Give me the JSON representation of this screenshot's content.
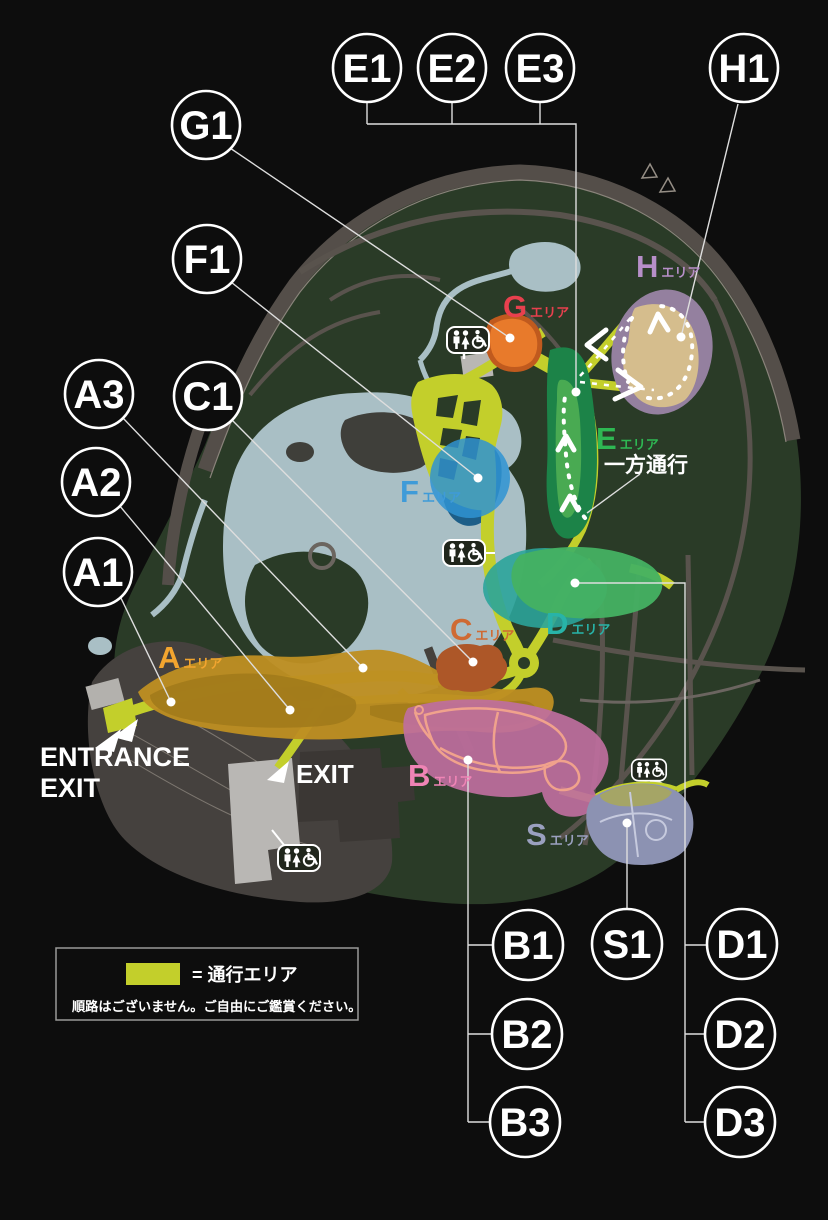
{
  "colors": {
    "background": "#0d0d0d",
    "park_green": "#2a3b27",
    "perimeter_gray": "#544e49",
    "road_gray": "#59534d",
    "entrance_zone_gray": "#45413e",
    "building_light": "#b9b7b4",
    "building_dark": "#3b3734",
    "pond_blue": "#a9bfc5",
    "deep_blue": "#1d5e88",
    "path_yellow": "#c3cf2b",
    "area_a": "#bd8f22",
    "area_a_dark": "#a0791a",
    "area_b": "#bf6f9e",
    "area_b_outline": "#f0a28c",
    "area_c": "#ad5728",
    "area_d_teal": "#2ba49a",
    "area_d_green": "#45b162",
    "area_e": "#1c8348",
    "area_e_light": "#4fae53",
    "area_f": "#2f93d2",
    "area_g": "#e87a2b",
    "area_g_border": "#c05a1e",
    "area_h_outer": "#94809f",
    "area_h_inner": "#d5bd8d",
    "area_s": "#8c92b2",
    "area_s_olive": "#a5a566",
    "label_a": "#f2a52f",
    "label_b": "#ef84b5",
    "label_c": "#cf6a33",
    "label_d": "#28b3a8",
    "label_e": "#2eb853",
    "label_f": "#3f9bd8",
    "label_g": "#e8404e",
    "label_h": "#b78fc9",
    "label_s": "#9aa0bf"
  },
  "markers": {
    "e1": "E1",
    "e2": "E2",
    "e3": "E3",
    "h1": "H1",
    "g1": "G1",
    "f1": "F1",
    "a3": "A3",
    "c1": "C1",
    "a2": "A2",
    "a1": "A1",
    "b1": "B1",
    "s1": "S1",
    "d1": "D1",
    "b2": "B2",
    "d2": "D2",
    "b3": "B3",
    "d3": "D3"
  },
  "areas": {
    "a": {
      "letter": "A",
      "suffix": "エリア"
    },
    "b": {
      "letter": "B",
      "suffix": "エリア"
    },
    "c": {
      "letter": "C",
      "suffix": "エリア"
    },
    "d": {
      "letter": "D",
      "suffix": "エリア"
    },
    "e": {
      "letter": "E",
      "suffix": "エリア"
    },
    "f": {
      "letter": "F",
      "suffix": "エリア"
    },
    "g": {
      "letter": "G",
      "suffix": "エリア"
    },
    "h": {
      "letter": "H",
      "suffix": "エリア"
    },
    "s": {
      "letter": "S",
      "suffix": "エリア"
    }
  },
  "entrance": {
    "line1": "ENTRANCE",
    "line2": "EXIT"
  },
  "exit": {
    "label": "EXIT"
  },
  "one_way": {
    "label": "一方通行"
  },
  "legend": {
    "text": "=  通行エリア",
    "note": "順路はございません。ご自由にご鑑賞ください。",
    "swatch_color": "#c3cf2b"
  }
}
